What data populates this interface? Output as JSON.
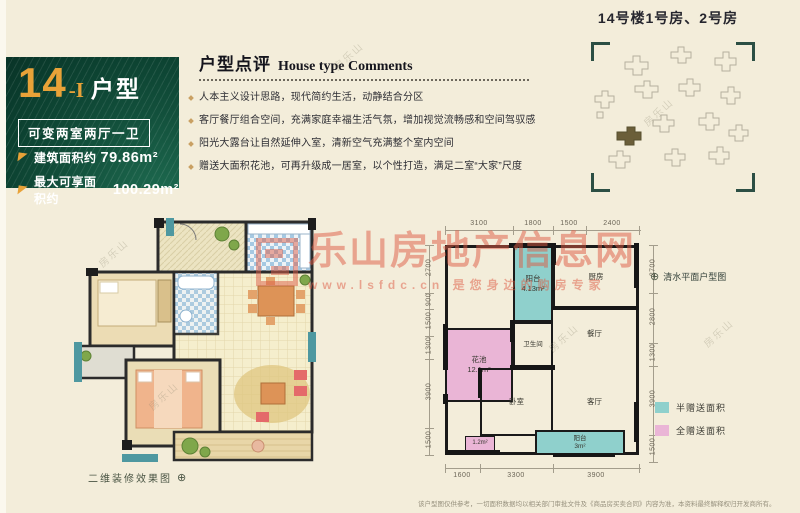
{
  "banner": {
    "number": "14",
    "suffix": "-I",
    "type_label": "户型",
    "variant": "可变两室两厅一卫",
    "areas": [
      {
        "label": "建筑面积约",
        "value": "79.86m²"
      },
      {
        "label": "最大可享面积约",
        "value": "100.29m²"
      }
    ]
  },
  "comments": {
    "title_cn": "户型点评",
    "title_en": "House type Comments",
    "bullets": [
      "人本主义设计思路，现代简约生活，动静结合分区",
      "客厅餐厅组合空间，充满家庭幸福生活气氛，增加视觉流畅感和空间驾驭感",
      "阳光大露台让自然延伸入室，清新空气充满整个室内空间",
      "赠送大面积花池，可再升级成一居室，以个性打造，满足二室“大家”尺度"
    ]
  },
  "siteplan": {
    "title": "14号楼1号房、2号房"
  },
  "left_plan": {
    "caption": "二维装修效果图",
    "compass": "⊕"
  },
  "right_plan": {
    "caption": "清水平面户型图",
    "compass": "⊕",
    "dims_top": [
      "3100",
      "1800",
      "1500",
      "2400"
    ],
    "dims_bottom": [
      "1600",
      "3300",
      "3900"
    ],
    "dims_left": [
      "2700",
      "900",
      "1500",
      "1300",
      "3900",
      "1500"
    ],
    "dims_right": [
      "2700",
      "2800",
      "1300",
      "3900",
      "1500"
    ],
    "rooms": {
      "balcony_top_label": "阳台",
      "balcony_top_area": "4.13m²",
      "kitchen": "厨房",
      "bathroom": "卫生间",
      "dining": "餐厅",
      "flower_label": "花池",
      "flower_area": "12.1m²",
      "bedroom": "卧室",
      "living": "客厅",
      "gift_area": "1.2m²",
      "balcony_bottom_label": "阳台",
      "balcony_bottom_area": "3m²"
    }
  },
  "legend": {
    "half": {
      "label": "半赠送面积",
      "color": "#8fd0cc"
    },
    "full": {
      "label": "全赠送面积",
      "color": "#eab5d6"
    }
  },
  "watermark": {
    "brand": "乐山房地产信息网",
    "tagline": "www.lsfdc.cn 是您身边的购房专家",
    "side_mark": "房乐山"
  },
  "disclaimer": "该户型图仅供参考，一切面积数据均以相关部门审批文件及《商品房买卖合同》内容为准，本资料最终解释权归开发商所有。",
  "colors": {
    "background": "#f3edda",
    "banner_green": "#0e4534",
    "accent_gold": "#e8a238",
    "teal": "#8fd0cc",
    "pink": "#eab5d6",
    "watermark_red": "#dd5f49"
  }
}
